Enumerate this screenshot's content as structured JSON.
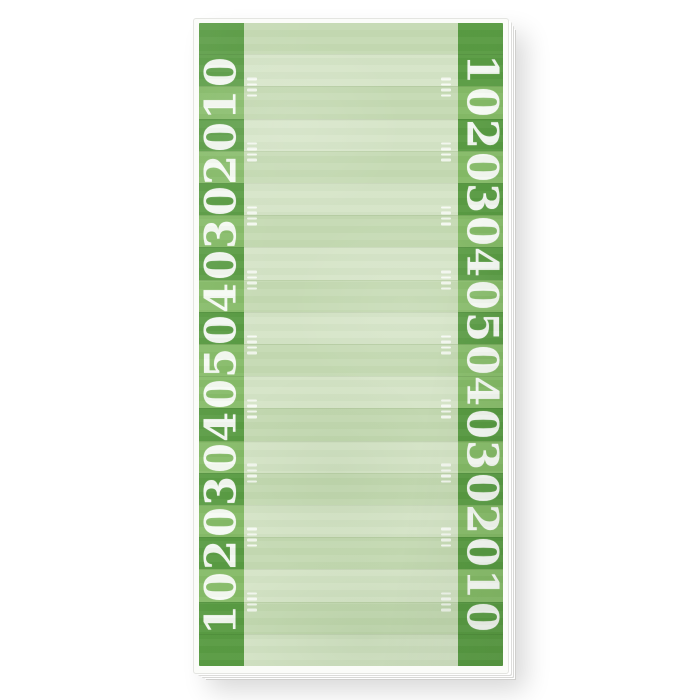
{
  "background_color": "#ffffff",
  "notepad": {
    "description_label": "football-field-notepad",
    "yard_numbers": [
      "10",
      "20",
      "30",
      "40",
      "50",
      "40",
      "30",
      "20",
      "10"
    ],
    "stripe_count": 20,
    "number_line_stripe_indices": [
      2,
      4,
      6,
      8,
      10,
      12,
      14,
      16,
      18
    ],
    "band_shades": [
      "dark",
      "dark",
      "mid",
      "dark",
      "mid",
      "dark",
      "mid",
      "dark",
      "mid",
      "dark",
      "mid",
      "mid",
      "dark",
      "mid",
      "dark",
      "mid",
      "dark",
      "mid",
      "dark",
      "dark"
    ],
    "field_shades": [
      "faint",
      "light",
      "faint",
      "light",
      "faint",
      "light",
      "faint",
      "light",
      "faint",
      "light",
      "faint",
      "light",
      "faint",
      "light",
      "faint",
      "light",
      "faint",
      "light",
      "faint",
      "light"
    ],
    "hash_dash_count": 4,
    "hash_clusters_per_line": 2,
    "colors": {
      "band_dark": "#579a41",
      "band_mid": "#84ba66",
      "field_light": "#d5e4c7",
      "field_faint": "#c5dab3",
      "number_white": "#ffffff",
      "hash_white": "#ffffff",
      "paper_white": "#fbfcf9",
      "sheet_edge_gray": "#d6d6d4",
      "background": "#ffffff"
    }
  }
}
